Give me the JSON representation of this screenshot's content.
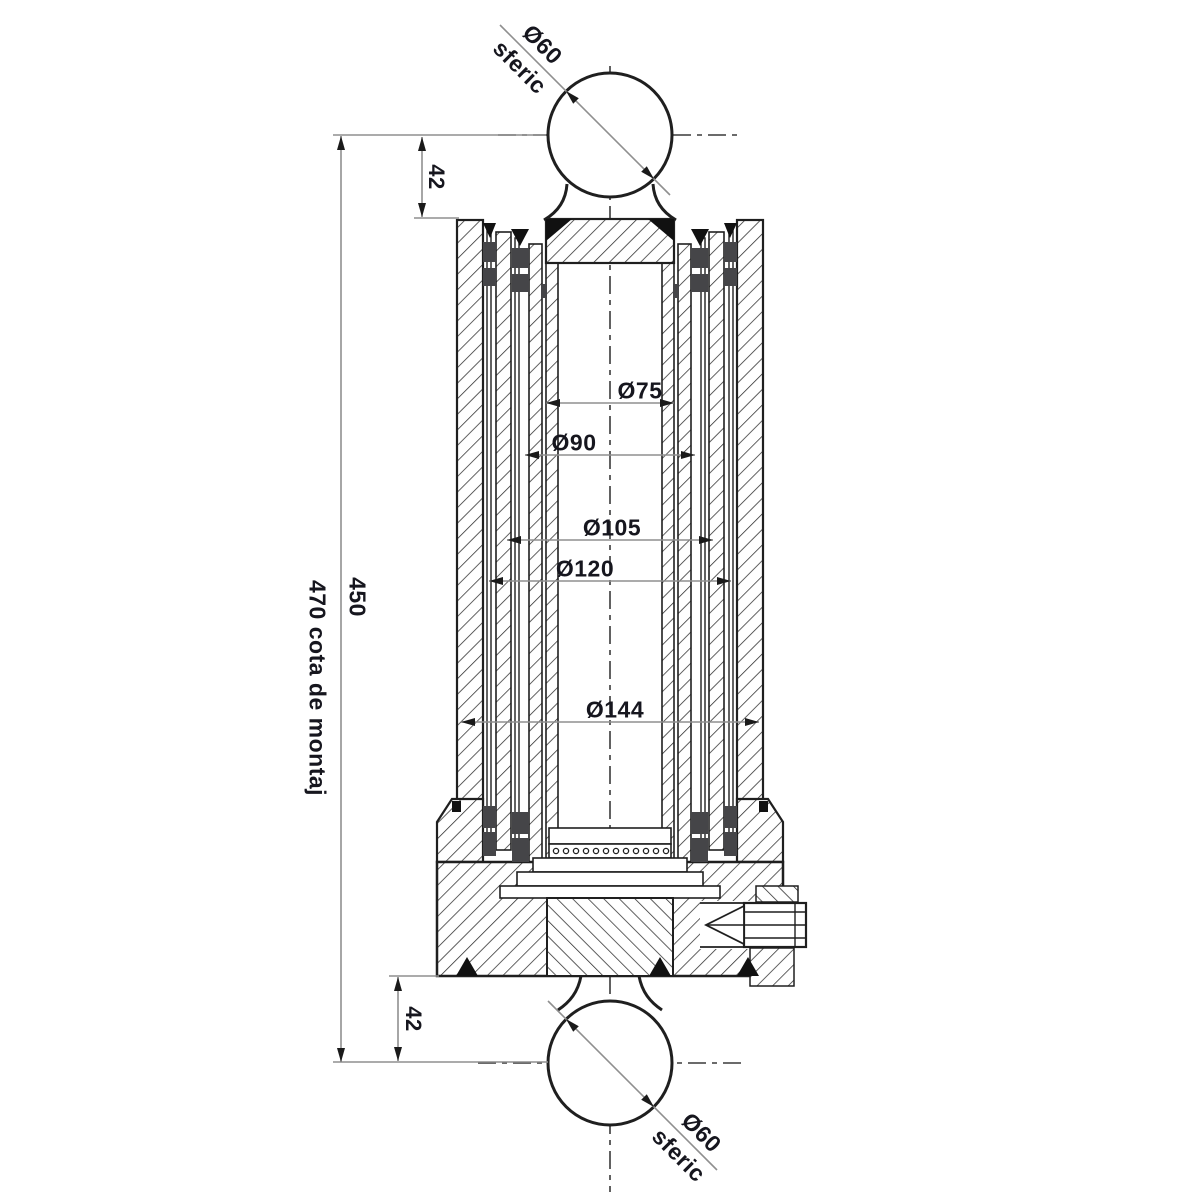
{
  "drawing": {
    "ball_top": {
      "diameter": "Ø60",
      "type": "sferic"
    },
    "ball_bottom": {
      "diameter": "Ø60",
      "type": "sferic"
    },
    "dimensions": {
      "top_ball_offset": "42",
      "bottom_ball_offset": "42",
      "stroke_length": "450",
      "mounting_note": "470 cota de montaj"
    },
    "stage_diameters": [
      {
        "label": "Ø75"
      },
      {
        "label": "Ø90"
      },
      {
        "label": "Ø105"
      },
      {
        "label": "Ø120"
      },
      {
        "label": "Ø144"
      }
    ],
    "colors": {
      "line": "#1f1f1f",
      "dimension_line": "#8f8f8f",
      "seal": "#454548",
      "text": "#16161e",
      "background": "#ffffff"
    }
  }
}
